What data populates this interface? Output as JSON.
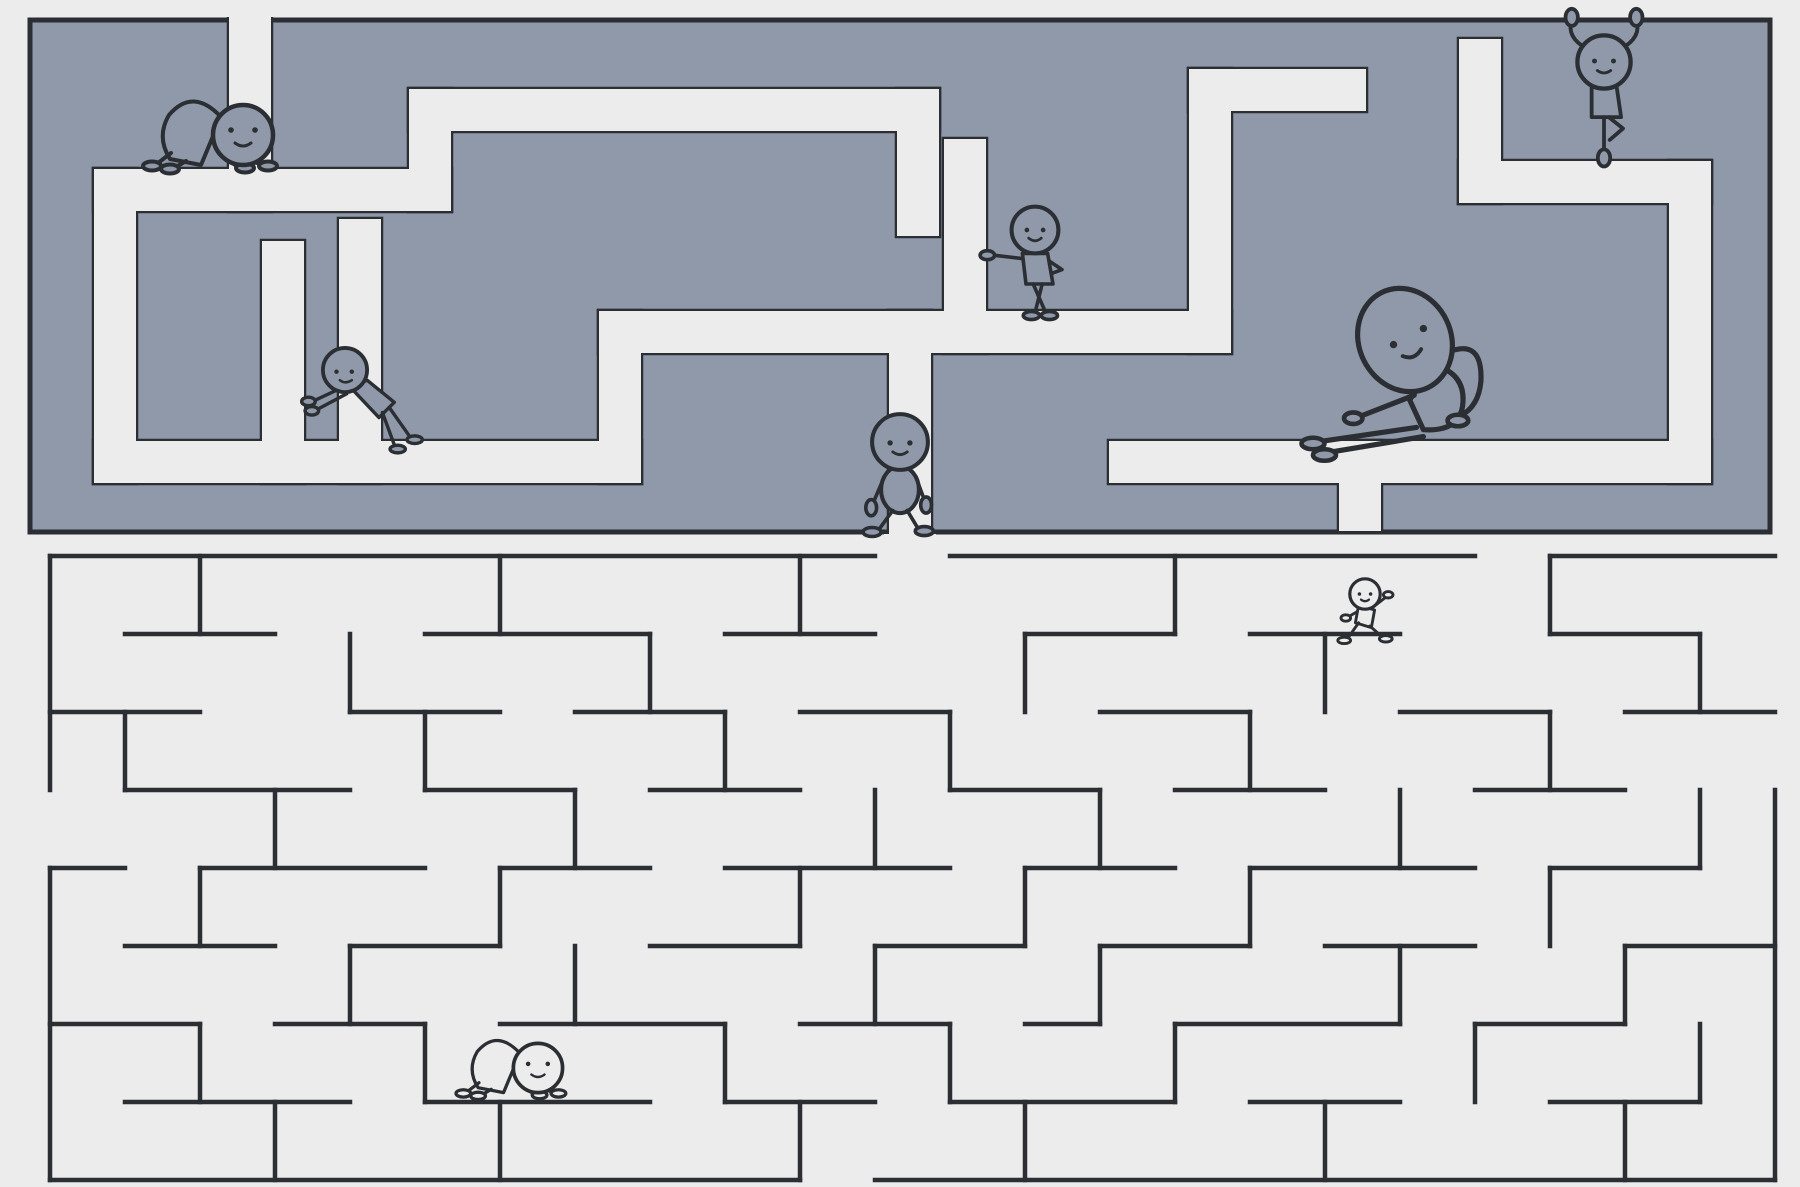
{
  "illustration": {
    "description": "Two stacked mazes with cartoon stick figures doing yoga and stretching poses",
    "aria_label": "Maze illustration with yoga characters"
  },
  "canvas": {
    "width": 1800,
    "height": 1187
  },
  "colors": {
    "background": "#ececec",
    "corridor_light": "#ececec",
    "maze_gray": "#8f99a9",
    "line_dark": "#2b2e33"
  },
  "top_maze": {
    "style": "gray blocks with light corridors",
    "bounds": {
      "x": 30,
      "y": 20,
      "w": 1740,
      "h": 512
    },
    "corridor_width": 42,
    "border_width": 5,
    "openings": [
      {
        "name": "entrance-top",
        "x": 250,
        "y": 20
      },
      {
        "name": "exit-bottom",
        "x": 910,
        "y": 532
      }
    ],
    "corridors": [
      {
        "name": "entrance-drop",
        "points": [
          [
            250,
            10
          ],
          [
            250,
            190
          ]
        ]
      },
      {
        "name": "cat-ledge",
        "points": [
          [
            115,
            190
          ],
          [
            430,
            190
          ]
        ]
      },
      {
        "name": "left-column",
        "points": [
          [
            115,
            190
          ],
          [
            115,
            462
          ]
        ]
      },
      {
        "name": "bottom-left-run",
        "points": [
          [
            115,
            462
          ],
          [
            620,
            462
          ]
        ]
      },
      {
        "name": "push-column",
        "points": [
          [
            283,
            462
          ],
          [
            283,
            262
          ]
        ]
      },
      {
        "name": "top-snake",
        "points": [
          [
            430,
            190
          ],
          [
            430,
            110
          ],
          [
            918,
            110
          ],
          [
            918,
            215
          ]
        ]
      },
      {
        "name": "mid-riser",
        "points": [
          [
            620,
            462
          ],
          [
            620,
            332
          ],
          [
            910,
            332
          ]
        ]
      },
      {
        "name": "exit-drop",
        "points": [
          [
            910,
            332
          ],
          [
            910,
            560
          ]
        ]
      },
      {
        "name": "lean-run",
        "points": [
          [
            910,
            332
          ],
          [
            1210,
            332
          ]
        ]
      },
      {
        "name": "lean-stub",
        "points": [
          [
            965,
            332
          ],
          [
            965,
            160
          ]
        ]
      },
      {
        "name": "right-snake",
        "points": [
          [
            1210,
            332
          ],
          [
            1210,
            90
          ],
          [
            1345,
            90
          ]
        ]
      },
      {
        "name": "tree-stub",
        "points": [
          [
            1480,
            182
          ],
          [
            1480,
            60
          ]
        ]
      },
      {
        "name": "tree-ledge",
        "points": [
          [
            1480,
            182
          ],
          [
            1690,
            182
          ],
          [
            1690,
            462
          ]
        ]
      },
      {
        "name": "bottom-right-run",
        "points": [
          [
            1690,
            462
          ],
          [
            1130,
            462
          ]
        ]
      },
      {
        "name": "border-stub",
        "points": [
          [
            1360,
            462
          ],
          [
            1360,
            510
          ]
        ]
      },
      {
        "name": "left-riser",
        "points": [
          [
            360,
            462
          ],
          [
            360,
            240
          ]
        ]
      }
    ],
    "erasers": [
      {
        "x": 226,
        "y": 0,
        "w": 48,
        "h": 17
      },
      {
        "x": 884,
        "y": 534,
        "w": 52,
        "h": 52
      }
    ]
  },
  "bottom_maze": {
    "style": "thin dark walls on light background",
    "grid": {
      "x0": 50,
      "y0": 556,
      "cell_w": 75,
      "cell_h": 78,
      "cols": 23,
      "rows": 8
    },
    "wall_width": 4.5,
    "segments": [
      [
        0,
        0,
        11,
        0
      ],
      [
        12,
        0,
        19,
        0
      ],
      [
        20,
        0,
        23,
        0
      ],
      [
        1,
        1,
        3,
        1
      ],
      [
        5,
        1,
        8,
        1
      ],
      [
        9,
        1,
        11,
        1
      ],
      [
        13,
        1,
        15,
        1
      ],
      [
        16,
        1,
        18,
        1
      ],
      [
        20,
        1,
        22,
        1
      ],
      [
        0,
        2,
        2,
        2
      ],
      [
        4,
        2,
        6,
        2
      ],
      [
        7,
        2,
        9,
        2
      ],
      [
        10,
        2,
        12,
        2
      ],
      [
        14,
        2,
        16,
        2
      ],
      [
        18,
        2,
        20,
        2
      ],
      [
        21,
        2,
        23,
        2
      ],
      [
        1,
        3,
        4,
        3
      ],
      [
        5,
        3,
        7,
        3
      ],
      [
        8,
        3,
        10,
        3
      ],
      [
        12,
        3,
        14,
        3
      ],
      [
        15,
        3,
        17,
        3
      ],
      [
        19,
        3,
        21,
        3
      ],
      [
        0,
        4,
        1,
        4
      ],
      [
        2,
        4,
        5,
        4
      ],
      [
        6,
        4,
        8,
        4
      ],
      [
        9,
        4,
        12,
        4
      ],
      [
        13,
        4,
        15,
        4
      ],
      [
        16,
        4,
        19,
        4
      ],
      [
        20,
        4,
        22,
        4
      ],
      [
        1,
        5,
        3,
        5
      ],
      [
        4,
        5,
        6,
        5
      ],
      [
        8,
        5,
        10,
        5
      ],
      [
        11,
        5,
        13,
        5
      ],
      [
        14,
        5,
        16,
        5
      ],
      [
        17,
        5,
        19,
        5
      ],
      [
        21,
        5,
        23,
        5
      ],
      [
        0,
        6,
        2,
        6
      ],
      [
        3,
        6,
        5,
        6
      ],
      [
        6,
        6,
        9,
        6
      ],
      [
        10,
        6,
        12,
        6
      ],
      [
        13,
        6,
        14,
        6
      ],
      [
        15,
        6,
        18,
        6
      ],
      [
        19,
        6,
        21,
        6
      ],
      [
        1,
        7,
        4,
        7
      ],
      [
        5,
        7,
        8,
        7
      ],
      [
        9,
        7,
        11,
        7
      ],
      [
        12,
        7,
        15,
        7
      ],
      [
        16,
        7,
        18,
        7
      ],
      [
        20,
        7,
        22,
        7
      ],
      [
        0,
        8,
        10,
        8
      ],
      [
        11,
        8,
        23,
        8
      ],
      [
        0,
        0,
        0,
        3
      ],
      [
        0,
        4,
        0,
        8
      ],
      [
        23,
        3,
        23,
        8
      ],
      [
        2,
        0,
        2,
        1
      ],
      [
        6,
        0,
        6,
        1
      ],
      [
        10,
        0,
        10,
        1
      ],
      [
        15,
        0,
        15,
        1
      ],
      [
        20,
        0,
        20,
        1
      ],
      [
        4,
        1,
        4,
        2
      ],
      [
        8,
        1,
        8,
        2
      ],
      [
        13,
        1,
        13,
        2
      ],
      [
        17,
        1,
        17,
        2
      ],
      [
        22,
        1,
        22,
        2
      ],
      [
        1,
        2,
        1,
        3
      ],
      [
        5,
        2,
        5,
        3
      ],
      [
        9,
        2,
        9,
        3
      ],
      [
        12,
        2,
        12,
        3
      ],
      [
        16,
        2,
        16,
        3
      ],
      [
        20,
        2,
        20,
        3
      ],
      [
        3,
        3,
        3,
        4
      ],
      [
        7,
        3,
        7,
        4
      ],
      [
        11,
        3,
        11,
        4
      ],
      [
        14,
        3,
        14,
        4
      ],
      [
        18,
        3,
        18,
        4
      ],
      [
        22,
        3,
        22,
        4
      ],
      [
        2,
        4,
        2,
        5
      ],
      [
        6,
        4,
        6,
        5
      ],
      [
        10,
        4,
        10,
        5
      ],
      [
        13,
        4,
        13,
        5
      ],
      [
        16,
        4,
        16,
        5
      ],
      [
        20,
        4,
        20,
        5
      ],
      [
        4,
        5,
        4,
        6
      ],
      [
        7,
        5,
        7,
        6
      ],
      [
        11,
        5,
        11,
        6
      ],
      [
        14,
        5,
        14,
        6
      ],
      [
        18,
        5,
        18,
        6
      ],
      [
        21,
        5,
        21,
        6
      ],
      [
        2,
        6,
        2,
        7
      ],
      [
        5,
        6,
        5,
        7
      ],
      [
        9,
        6,
        9,
        7
      ],
      [
        12,
        6,
        12,
        7
      ],
      [
        15,
        6,
        15,
        7
      ],
      [
        19,
        6,
        19,
        7
      ],
      [
        22,
        6,
        22,
        7
      ],
      [
        3,
        7,
        3,
        8
      ],
      [
        6,
        7,
        6,
        8
      ],
      [
        10,
        7,
        10,
        8
      ],
      [
        13,
        7,
        13,
        8
      ],
      [
        17,
        7,
        17,
        8
      ],
      [
        21,
        7,
        21,
        8
      ]
    ]
  },
  "figures": [
    {
      "name": "figure-cat-stretch-top",
      "symbol": "fig-cat",
      "pose": "cat stretch on all fours",
      "x": 215,
      "y": 135,
      "scale": 1.0,
      "variant": "gray"
    },
    {
      "name": "figure-wall-push",
      "symbol": "fig-push",
      "pose": "leaning forward pushing against wall",
      "x": 345,
      "y": 370,
      "scale": 0.85,
      "variant": "gray"
    },
    {
      "name": "figure-wall-lean",
      "symbol": "fig-lean",
      "pose": "standing leaning on wall, legs crossed",
      "x": 1035,
      "y": 230,
      "scale": 0.9,
      "variant": "gray"
    },
    {
      "name": "figure-walker",
      "symbol": "fig-walk",
      "pose": "walking through maze opening",
      "x": 900,
      "y": 442,
      "scale": 0.9,
      "variant": "gray"
    },
    {
      "name": "figure-seated-side-bend",
      "symbol": "fig-sit",
      "pose": "seated side bend toward feet",
      "x": 1405,
      "y": 340,
      "scale": 1.15,
      "variant": "gray"
    },
    {
      "name": "figure-tree-pose",
      "symbol": "fig-tree",
      "pose": "tree pose with raised arms",
      "x": 1604,
      "y": 62,
      "scale": 0.95,
      "variant": "gray"
    },
    {
      "name": "figure-lunge",
      "symbol": "fig-lunge",
      "pose": "low lunge stretch",
      "x": 1365,
      "y": 594,
      "scale": 0.8,
      "variant": "light"
    },
    {
      "name": "figure-cat-stretch-bottom",
      "symbol": "fig-cat",
      "pose": "cat stretch on all fours",
      "x": 515,
      "y": 1068,
      "scale": 0.82,
      "variant": "light"
    }
  ]
}
